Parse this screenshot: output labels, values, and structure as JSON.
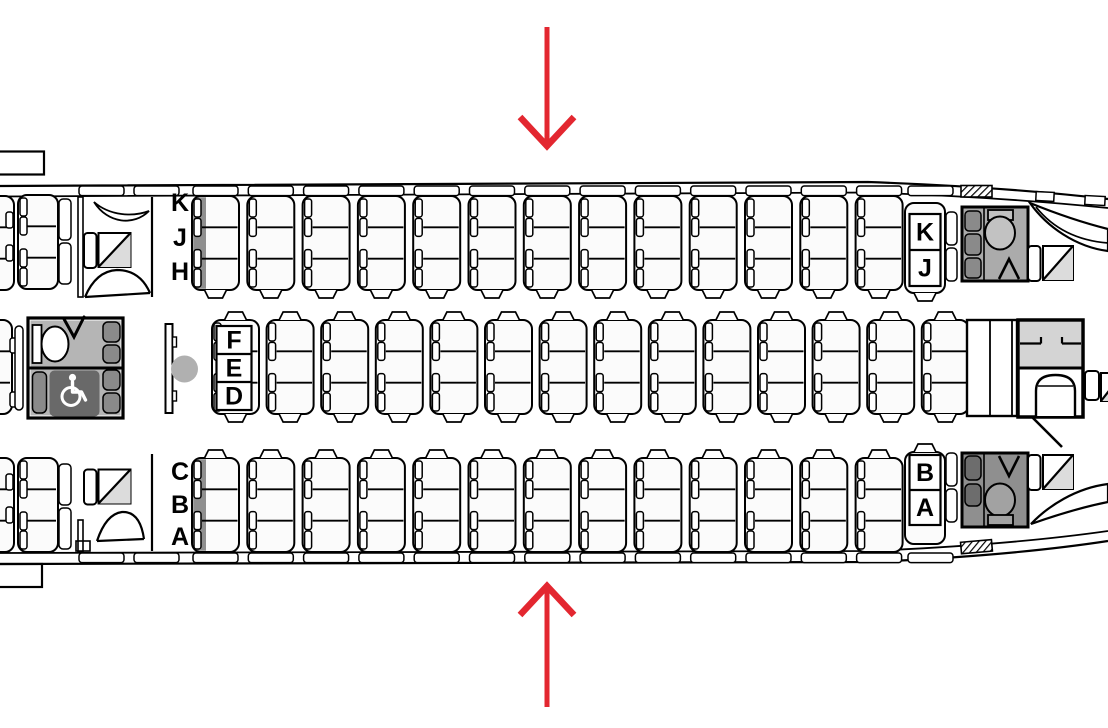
{
  "colors": {
    "arrow_red": "#e32730",
    "stripe_gray": "#8f8f8f",
    "lav_light_gray": "#b5b5b5",
    "lav_medium_gray": "#ababab",
    "lav_dark_gray": "#8f8f8f",
    "panel_dark_gray": "#696969",
    "galley_gray": "#d4d4d4",
    "jumpseat_triangle_gray": "#dcdcdc",
    "marker_gray": "#b0b0b0",
    "seat_fill": "#fbfbfb",
    "outline_black": "#000000"
  },
  "labels": {
    "left_top": [
      "K",
      "J",
      "H"
    ],
    "mid_front": [
      "F",
      "E",
      "D"
    ],
    "left_bottom": [
      "C",
      "B",
      "A"
    ],
    "right_top": [
      "K",
      "J"
    ],
    "right_bottom": [
      "B",
      "A"
    ]
  },
  "cabin": {
    "rows_top_3seat_units": 13,
    "rows_middle_3seat_units": 14,
    "rows_bottom_3seat_units": 13,
    "right_end_pair_units": 2,
    "seats_per_unit": 3
  },
  "icons": {
    "accessible_lavatory": "wheelchair-icon",
    "lavatory": "toilet-icon",
    "boarding_door_top": "arrow-down-icon",
    "boarding_door_bottom": "arrow-up-icon",
    "galley_cart": "trolley-icon",
    "crew_seat": "diagonal-square-icon"
  }
}
